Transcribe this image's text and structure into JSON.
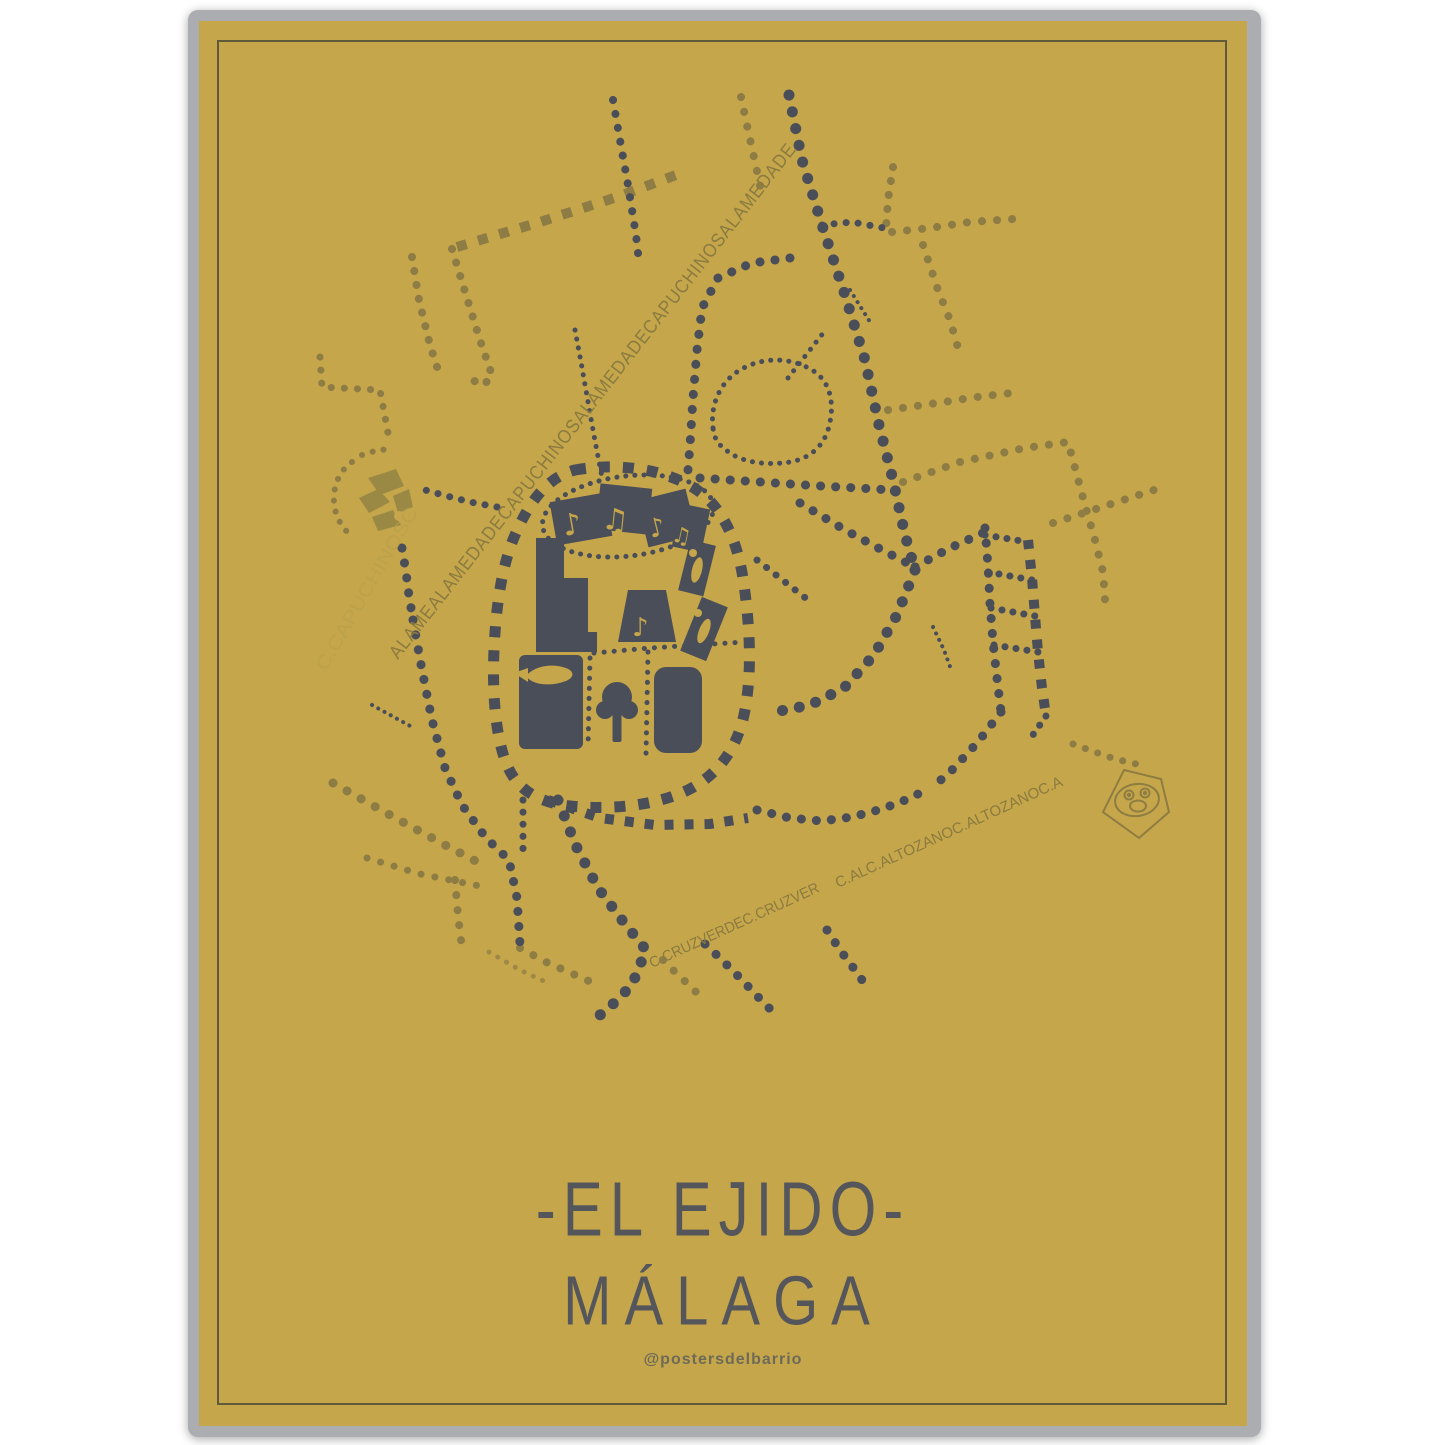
{
  "poster": {
    "neighborhood_title": "-EL EJIDO-",
    "city_title": "MÁLAGA",
    "credit": "@postersdelbarrio",
    "street_labels": {
      "alameda_diagonal": "ALAMEALAMEDADECAPUCHINOSALAMEDADECAPUCHINOSALAMEDADE",
      "capuchinos_faint": "C.CAPUCHINOSC",
      "cruzverde": "C.CRUZVERDEC.CRUZVER",
      "altozano": "C.ALC.ALTOZANOC.ALTOZANOC.A"
    },
    "colors": {
      "poster_background": "#c6a64a",
      "frame_gray": "#acadb0",
      "inner_border": "#5e5a3a",
      "street_dark": "#4a4e58",
      "street_olive": "#8d7c44",
      "street_faint": "#b39b4a",
      "title_text": "#54565c",
      "label_olive": "#8a7b40"
    },
    "icons": [
      "monkey-logo-icon",
      "plaza-fragments-icon",
      "tree-icon",
      "paintbrush-icon",
      "music-notes-icon"
    ]
  }
}
